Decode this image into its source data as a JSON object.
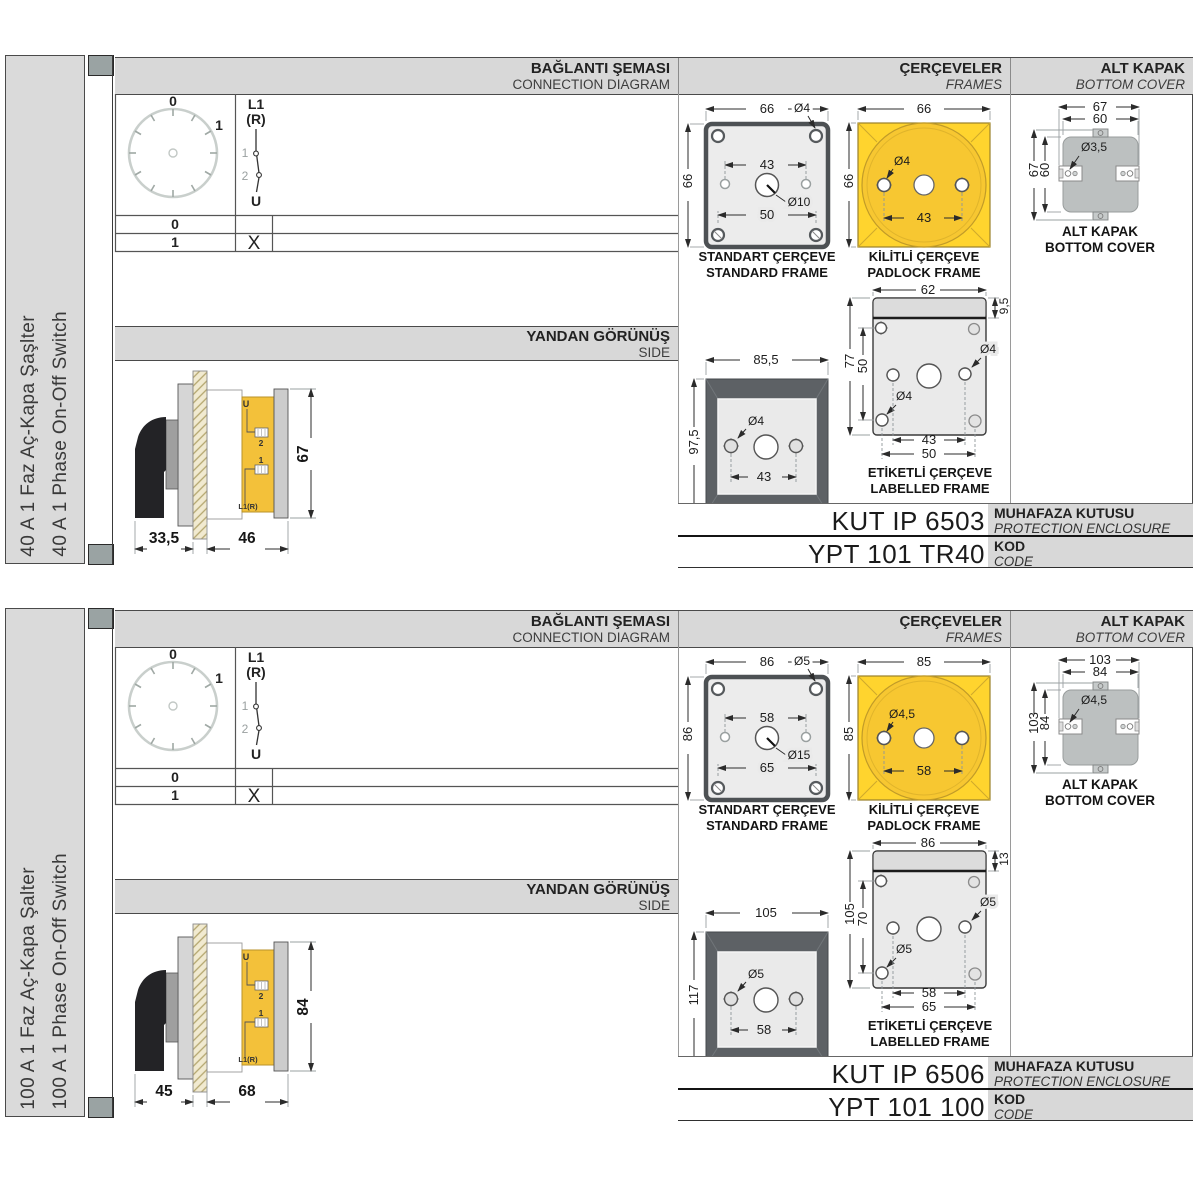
{
  "colors": {
    "accent_yellow": "#FFD42E",
    "header_gray": "#d8d8d8",
    "cover_gray": "#bcc0c0"
  },
  "sections": [
    {
      "left_label_tr": "40 A 1 Faz Aç-Kapa Şaşlter",
      "left_label_en": "40 A 1 Phase On-Off Switch",
      "header": {
        "connection_tr": "BAĞLANTI ŞEMASI",
        "connection_en": "CONNECTION DIAGRAM",
        "frames_tr": "ÇERÇEVELER",
        "frames_en": "FRAMES",
        "cover_tr": "ALT KAPAK",
        "cover_en": "BOTTOM COVER"
      },
      "diagram": {
        "dial_top": "0",
        "dial_right": "1",
        "in_label": "L1",
        "in_label2": "(R)",
        "contact1": "1",
        "contact2": "2",
        "out_label": "U",
        "row1_pos": "0",
        "row1_mark": "",
        "row2_pos": "1",
        "row2_mark": "X"
      },
      "side": {
        "title_tr": "YANDAN GÖRÜNÜŞ",
        "title_en": "SIDE",
        "dim_depth": "33,5",
        "dim_width": "46",
        "dim_height": "67",
        "u": "U",
        "t2": "2",
        "t1": "1",
        "l1r": "L1(R)"
      },
      "standard": {
        "dim_top": "66",
        "dim_left": "66",
        "hole_corner": "Ø4",
        "dim_holes": "43",
        "hole_center": "Ø10",
        "dim_bottom": "50",
        "label_tr": "STANDART ÇERÇEVE",
        "label_en": "STANDARD FRAME"
      },
      "padlock": {
        "dim_top": "66",
        "dim_left": "66",
        "hole": "Ø4",
        "dim_holes": "43",
        "label_tr": "KİLİTLİ ÇERÇEVE",
        "label_en": "PADLOCK FRAME"
      },
      "wide": {
        "dim_top": "85,5",
        "dim_left": "97,5",
        "hole": "Ø4",
        "dim_holes": "43",
        "label_tr": "GENİŞ ÇERÇEVE",
        "label_en": "WIDE FRAME"
      },
      "labelled": {
        "dim_top": "62",
        "dim_strip": "9,5",
        "dim_left": "77",
        "dim_left_inner": "50",
        "hole_mid": "Ø4",
        "hole_bottom": "Ø4",
        "dim_bottom1": "43",
        "dim_bottom2": "50",
        "label_tr": "ETİKETLİ ÇERÇEVE",
        "label_en": "LABELLED FRAME"
      },
      "cover": {
        "dim_top_outer": "67",
        "dim_top_inner": "60",
        "hole": "Ø3,5",
        "dim_left_outer": "67",
        "dim_left_inner": "60",
        "label_tr": "ALT KAPAK",
        "label_en": "BOTTOM COVER"
      },
      "codes": {
        "enclosure": "KUT IP 6503",
        "enclosure_tr": "MUHAFAZA KUTUSU",
        "enclosure_en": "PROTECTION ENCLOSURE",
        "code": "YPT 101 TR40",
        "code_tr": "KOD",
        "code_en": "CODE"
      }
    },
    {
      "left_label_tr": "100 A 1 Faz Aç-Kapa Şalter",
      "left_label_en": "100 A 1 Phase On-Off Switch",
      "header": {
        "connection_tr": "BAĞLANTI ŞEMASI",
        "connection_en": "CONNECTION DIAGRAM",
        "frames_tr": "ÇERÇEVELER",
        "frames_en": "FRAMES",
        "cover_tr": "ALT KAPAK",
        "cover_en": "BOTTOM COVER"
      },
      "diagram": {
        "dial_top": "0",
        "dial_right": "1",
        "in_label": "L1",
        "in_label2": "(R)",
        "contact1": "1",
        "contact2": "2",
        "out_label": "U",
        "row1_pos": "0",
        "row1_mark": "",
        "row2_pos": "1",
        "row2_mark": "X"
      },
      "side": {
        "title_tr": "YANDAN GÖRÜNÜŞ",
        "title_en": "SIDE",
        "dim_depth": "45",
        "dim_width": "68",
        "dim_height": "84",
        "u": "U",
        "t2": "2",
        "t1": "1",
        "l1r": "L1(R)"
      },
      "standard": {
        "dim_top": "86",
        "dim_left": "86",
        "hole_corner": "Ø5",
        "dim_holes": "58",
        "hole_center": "Ø15",
        "dim_bottom": "65",
        "label_tr": "STANDART ÇERÇEVE",
        "label_en": "STANDARD FRAME"
      },
      "padlock": {
        "dim_top": "85",
        "dim_left": "85",
        "hole": "Ø4,5",
        "dim_holes": "58",
        "label_tr": "KİLİTLİ ÇERÇEVE",
        "label_en": "PADLOCK FRAME"
      },
      "wide": {
        "dim_top": "105",
        "dim_left": "117",
        "hole": "Ø5",
        "dim_holes": "58",
        "label_tr": "GENİŞ ÇERÇEVE",
        "label_en": "WIDE FRAME"
      },
      "labelled": {
        "dim_top": "86",
        "dim_strip": "13",
        "dim_left": "105",
        "dim_left_inner": "70",
        "hole_mid": "Ø5",
        "hole_bottom": "Ø5",
        "dim_bottom1": "58",
        "dim_bottom2": "65",
        "label_tr": "ETİKETLİ ÇERÇEVE",
        "label_en": "LABELLED FRAME"
      },
      "cover": {
        "dim_top_outer": "103",
        "dim_top_inner": "84",
        "hole": "Ø4,5",
        "dim_left_outer": "103",
        "dim_left_inner": "84",
        "label_tr": "ALT KAPAK",
        "label_en": "BOTTOM COVER"
      },
      "codes": {
        "enclosure": "KUT IP 6506",
        "enclosure_tr": "MUHAFAZA KUTUSU",
        "enclosure_en": "PROTECTION ENCLOSURE",
        "code": "YPT 101 100",
        "code_tr": "KOD",
        "code_en": "CODE"
      }
    }
  ]
}
